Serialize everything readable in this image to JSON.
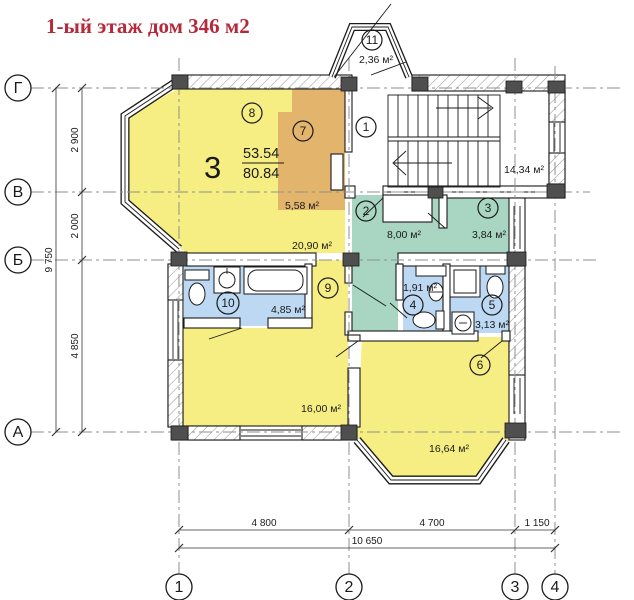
{
  "title": "1-ый этаж дом  346 м2",
  "apartment": {
    "number": "3",
    "upper_area": "53.54",
    "lower_area": "80.84"
  },
  "rooms": {
    "r1": {
      "num": "1",
      "area": "14,34 м²"
    },
    "r2": {
      "num": "2",
      "area": "8,00 м²"
    },
    "r3": {
      "num": "3",
      "area": "3,84 м²"
    },
    "r4": {
      "num": "4",
      "area": "1,91 м²"
    },
    "r5": {
      "num": "5",
      "area": "3,13 м²"
    },
    "r6": {
      "num": "6",
      "area": "16,64 м²"
    },
    "r7": {
      "num": "7",
      "area": "5,58 м²"
    },
    "r8": {
      "num": "8",
      "area": "20,90 м²"
    },
    "r9": {
      "num": "9",
      "area": "16,00 м²"
    },
    "r10": {
      "num": "10",
      "area": "4,85 м²"
    },
    "r11": {
      "num": "11",
      "area": "2,36 м²"
    }
  },
  "axes": {
    "g": "Г",
    "v": "В",
    "b": "Б",
    "a": "А",
    "c1": "1",
    "c2": "2",
    "c3": "3",
    "c4": "4"
  },
  "dims": {
    "v1": "2 900",
    "v2": "2 000",
    "v3": "4 850",
    "v_total": "9 750",
    "h1": "4 800",
    "h2": "4 700",
    "h3": "1 150",
    "h_total": "10 650"
  },
  "colors": {
    "accent_title": "#b5293b",
    "room_yellow": "#f6ee82",
    "room_orange": "#e3b46c",
    "room_teal": "#a8d6c2",
    "room_blue": "#bcd8f2",
    "wall_dark": "#4f4f4f",
    "axis_line": "#8f8f8f"
  }
}
